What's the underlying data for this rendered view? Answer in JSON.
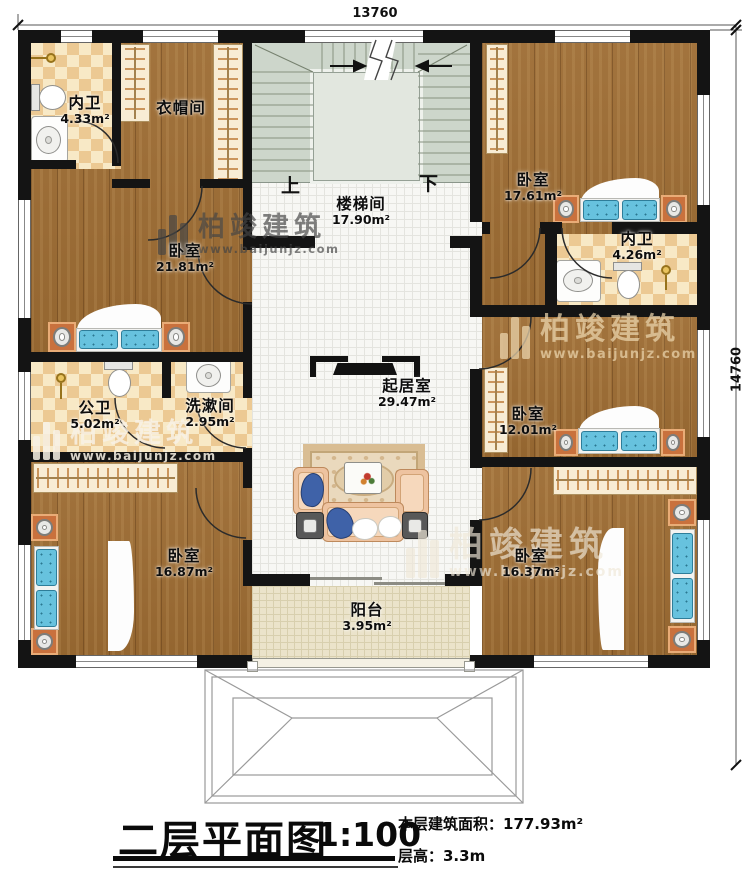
{
  "dimensions": {
    "top": "13760",
    "right": "14760"
  },
  "rooms": {
    "neiwei_tl": {
      "name": "内卫",
      "area": "4.33m²"
    },
    "yimaojian": {
      "name": "衣帽间"
    },
    "woshi_tl": {
      "name": "卧室",
      "area": "21.81m²"
    },
    "loutijian": {
      "name": "楼梯间",
      "area": "17.90m²"
    },
    "woshi_tr": {
      "name": "卧室",
      "area": "17.61m²"
    },
    "neiwei_r": {
      "name": "内卫",
      "area": "4.26m²"
    },
    "gongwei": {
      "name": "公卫",
      "area": "5.02m²"
    },
    "xishujian": {
      "name": "洗漱间",
      "area": "2.95m²"
    },
    "qijushi": {
      "name": "起居室",
      "area": "29.47m²"
    },
    "woshi_mr": {
      "name": "卧室",
      "area": "12.01m²"
    },
    "woshi_bl": {
      "name": "卧室",
      "area": "16.87m²"
    },
    "woshi_br": {
      "name": "卧室",
      "area": "16.37m²"
    },
    "yangtai": {
      "name": "阳台",
      "area": "3.95m²"
    }
  },
  "stairs": {
    "up": "上",
    "down": "下"
  },
  "title": {
    "main": "二层平面图",
    "scale": "1:100",
    "area_line": "本层建筑面积：177.93m²",
    "height_line": "层高：3.3m"
  },
  "watermark": {
    "brand": "柏竣建筑",
    "url": "www.baijunjz.com"
  }
}
